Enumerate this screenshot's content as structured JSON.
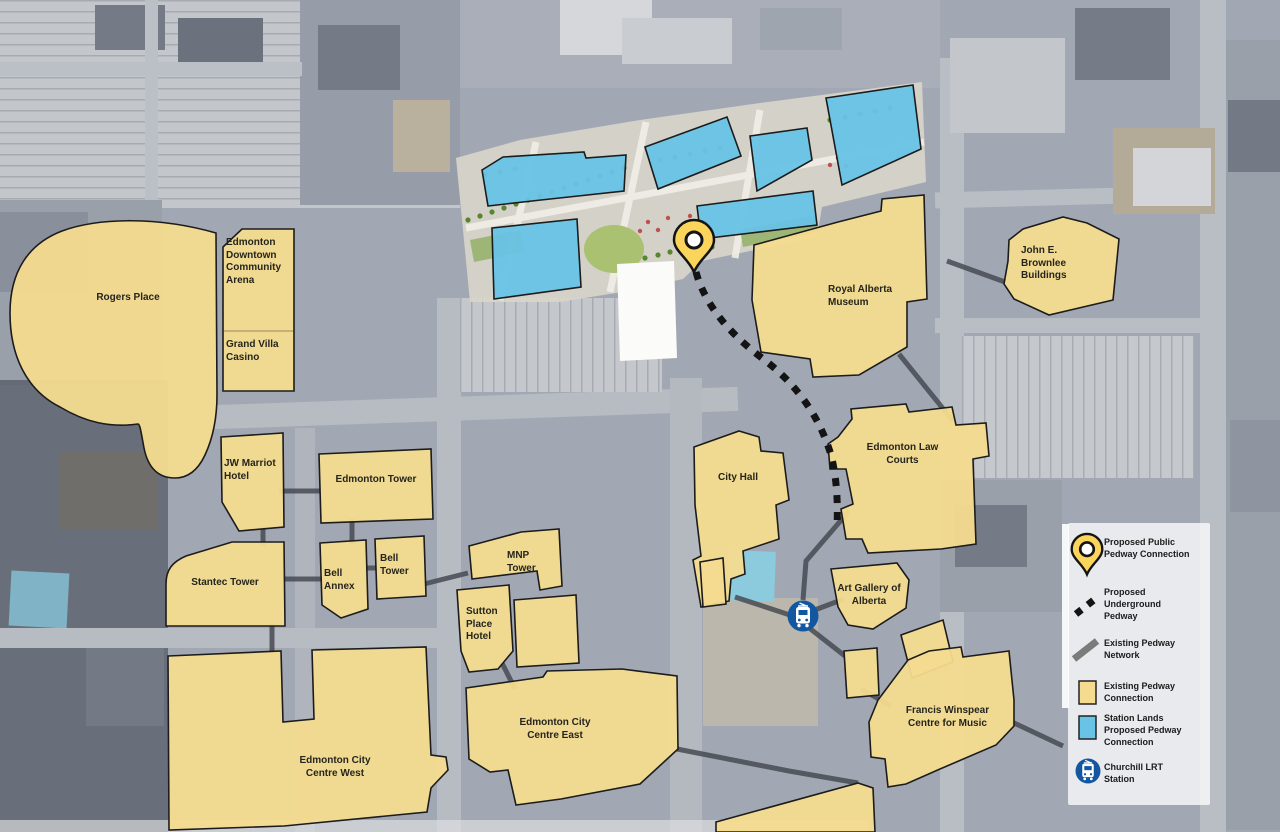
{
  "map": {
    "buildings": {
      "rogers_place": "Rogers Place",
      "community_arena": "Edmonton Downtown Community Arena",
      "grand_villa_casino": "Grand Villa Casino",
      "jw_marriot_hotel": "JW Marriot Hotel",
      "edmonton_tower": "Edmonton Tower",
      "stantec_tower": "Stantec Tower",
      "bell_annex": "Bell Annex",
      "bell_tower": "Bell Tower",
      "mnp_tower": "MNP Tower",
      "sutton_place_hotel": "Sutton Place Hotel",
      "ecc_west": "Edmonton City Centre West",
      "ecc_east": "Edmonton City Centre East",
      "city_hall": "City Hall",
      "law_courts": "Edmonton Law Courts",
      "art_gallery": "Art Gallery of Alberta",
      "winspear": "Francis Winspear Centre for Music",
      "museum": "Royal Alberta Museum",
      "brownlee": "John E. Brownlee Buildings"
    },
    "colors": {
      "existing_connection_yellow": "#F4DB8F",
      "station_lands_blue": "#68C3E6",
      "outline": "#1c1c1c",
      "pedway_network_gray": "#41444c",
      "underground_pedway_black": "#141414",
      "pin_yellow": "#FBD45C",
      "lrt_blue": "#1257A0"
    }
  },
  "legend": {
    "items": [
      {
        "id": "pin",
        "label": "Proposed Public Pedway Connection"
      },
      {
        "id": "underground",
        "label": "Proposed Underground Pedway"
      },
      {
        "id": "network",
        "label": "Existing Pedway Network"
      },
      {
        "id": "existing_connection",
        "label": "Existing Pedway Connection"
      },
      {
        "id": "station_lands",
        "label": "Station Lands Proposed Pedway Connection"
      },
      {
        "id": "lrt",
        "label": "Churchill LRT Station"
      }
    ]
  }
}
